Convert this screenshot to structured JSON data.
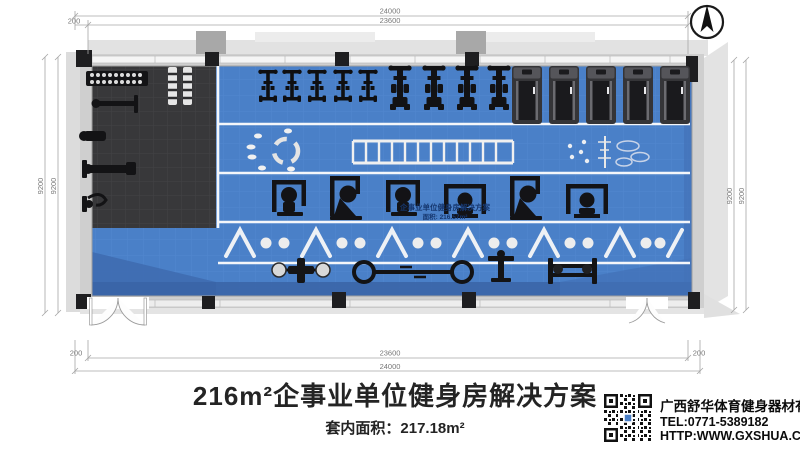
{
  "dims": {
    "top_outer": "24000",
    "top_inner": "23600",
    "top_offset": "200",
    "bottom_inner": "23600",
    "bottom_outer": "24000",
    "bottom_offset_left": "200",
    "bottom_offset_right": "200",
    "left_outer": "9200",
    "left_inner": "9200",
    "right_inner": "9200",
    "right_outer": "9200"
  },
  "watermark": {
    "line1": "企事业单位健身房解决方案",
    "line2": "面积: 216.57m²"
  },
  "footer": {
    "title": "216m²企事业单位健身房解决方案",
    "area": "套内面积：217.18m²"
  },
  "company": {
    "name": "广西舒华体育健身器材有限公司",
    "tel": "TEL:0771-5389182",
    "site": "HTTP:WWW.GXSHUA.COM"
  },
  "colors": {
    "floor_blue": "#4a80c8",
    "mat_dark": "#39393b",
    "wall_gray": "#cfcfcf",
    "shadow_blue": "#3a64a6"
  }
}
